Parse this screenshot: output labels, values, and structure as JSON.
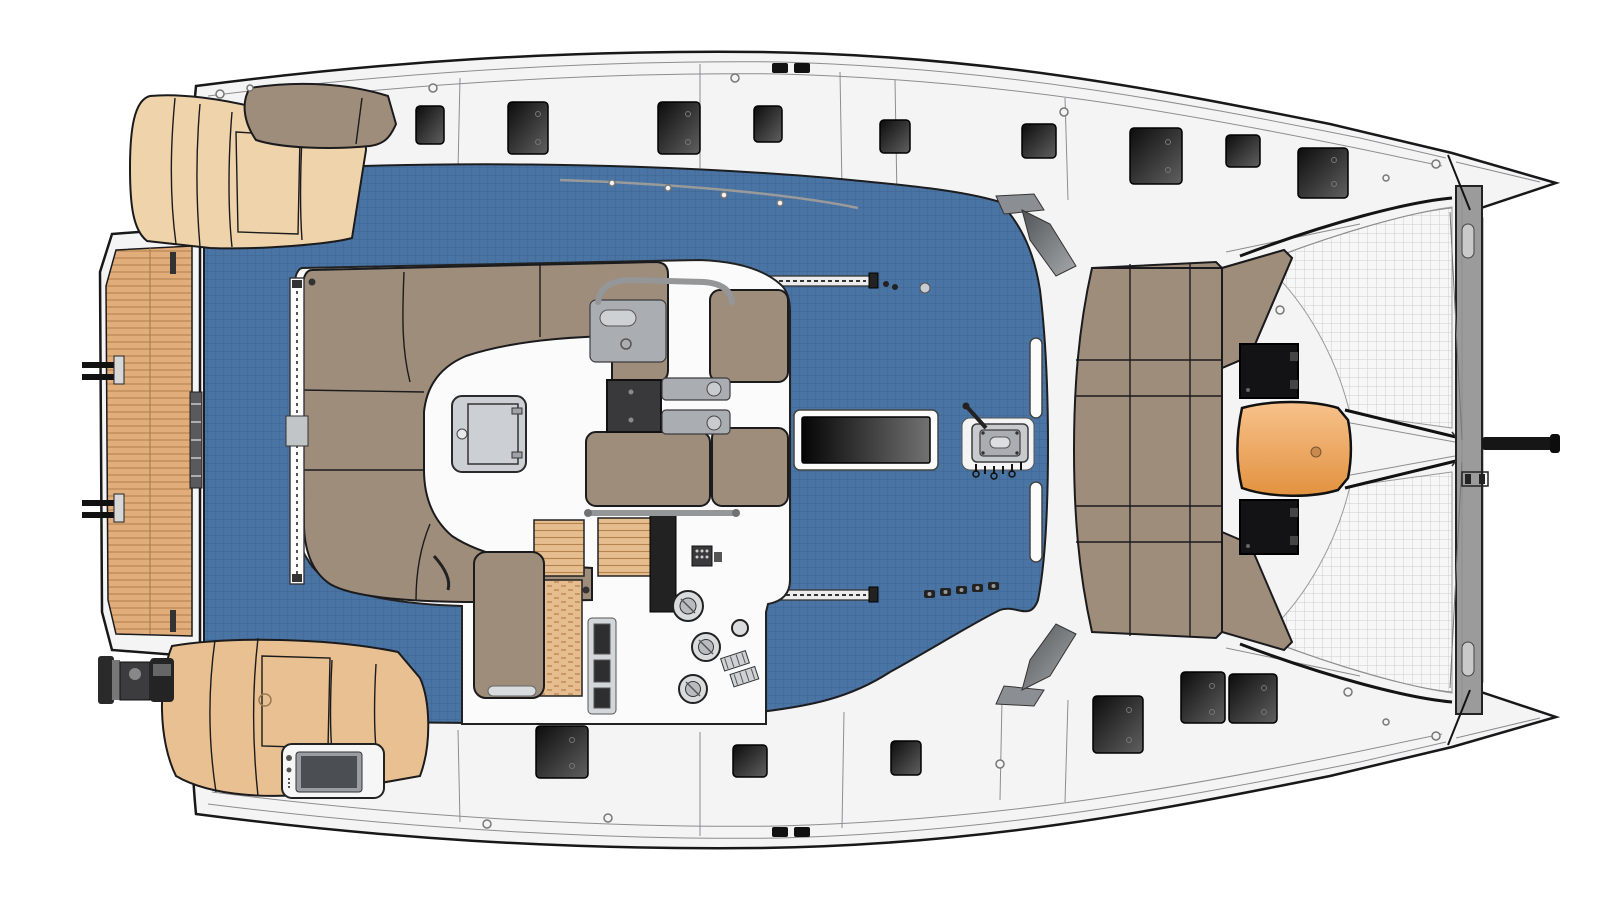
{
  "diagram": {
    "kind": "catamaran-deck-plan-top-view",
    "parts": {
      "hull": "hull and side decks",
      "swim_platform": "aft teak swim platform",
      "aft_port_sunbed": "aft port cushioned sunbed",
      "aft_backrest": "aft sunbed backrest",
      "aft_starboard_sunbed": "aft starboard cushioned sunbed",
      "transom_module": "transom module with screen",
      "outboard_engine": "dinghy outboard engine stowage",
      "cockpit_floor": "flybridge cockpit floor",
      "salon_lounge": "flybridge lounge island",
      "sofa": "U-shaped lounge sofa",
      "seat_pad": "lounge seat pad",
      "dinette_table": "folding cockpit table",
      "galley_sink": "wet-bar sink unit",
      "companionway": "companionway opening",
      "tray": "drink tray",
      "steps": "woven steps to helm",
      "helm_seat": "helm bench seat",
      "helm_console": "helm instrument console",
      "winch": "sheet winch",
      "vent": "engine vent",
      "keypad": "control keypad",
      "handrail": "stainless handrail",
      "door_track": "sliding door track",
      "skylight": "salon skylight window",
      "clutch_panel": "halyard clutch and jammer panel",
      "traveler": "mainsheet traveler track",
      "cam_cleats": "cam cleat row",
      "grab_rail": "coachroof grab rail",
      "windshield": "windshield corner panel",
      "foredeck_sunpad": "foredeck sunbathing pad",
      "foredeck_table": "foredeck teak cocktail table",
      "foredeck_hatch": "foredeck storage hatch",
      "deck_hatch": "flush deck hatch",
      "trampoline": "bow trampoline net",
      "anchor_channel": "anchor bridle channel",
      "bow_roller": "bow anchor roller",
      "crossbeam": "forward crossbeam",
      "bowsprit": "bowsprit pole",
      "bow_tip": "bow tip",
      "cleat": "mooring cleat",
      "deck_ring": "deck filler ring"
    },
    "colors": {
      "deck_white": "#f4f4f5",
      "hull_outline": "#18181a",
      "cockpit_blue": "#4a74a3",
      "cockpit_blue_grid": "#3d6491",
      "upholstery_taupe": "#9e8d7b",
      "cushion_tan": "#efd4ab",
      "cushion_tan_aft": "#e9c091",
      "teak": "#e0ad7b",
      "teak_plank": "#b07e4a",
      "wicker": "#e6bd8e",
      "table_orange": "#eda15d",
      "hatch_dark": "#1c1c1e",
      "panel_gray": "#c7cbce",
      "mesh_white": "#f7f7f7",
      "mesh_grid": "#cdcdcd",
      "crossbeam_gray": "#9b9b9b",
      "skylight_black": "#060606"
    }
  }
}
